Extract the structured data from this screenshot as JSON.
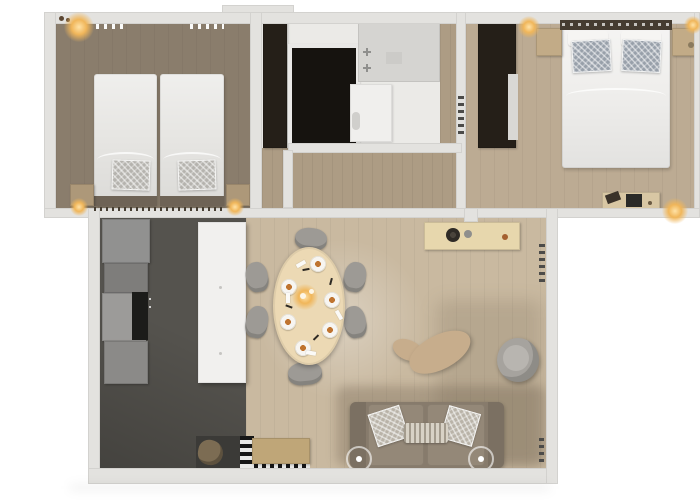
{
  "palette": {
    "background": "#ffffff",
    "wall": "#e3e2df",
    "bedroom1_floor": "#8a7d6c",
    "bedroom2_floor": "#bcab93",
    "hallway_floor": "#ad9c84",
    "bathroom_floor": "#ebeae7",
    "living_wood": "#c9b9a0",
    "kitchen_floor": "#55534e",
    "kitchen_cabinet": "#919190",
    "kitchen_island": "#f1f0ee",
    "dark_wardrobe": "#251f18",
    "shower_dark": "#16130f",
    "shower_tray": "#d5d4d1",
    "bed_linen": "#e7e6e3",
    "bed_linen_double": "#efeeec",
    "pillow_gray": "#b5b3ae",
    "pillow_blue_gray": "#98a0aa",
    "headboard_dark": "#6e6356",
    "headboard_double": "#453c31",
    "nightstand_wood": "#ad9879",
    "nightstand_wood_light": "#c2ab87",
    "desk_wood": "#d8c7a4",
    "sideboard_wood": "#e7d7ad",
    "dining_table": "#ecd9b4",
    "chair_gray": "#9d9a95",
    "sofa_body": "#877b6c",
    "sofa_arm": "#7b7062",
    "sofa_seat": "#948878",
    "sofa_cushion": "#b9b3a8",
    "lumbar_cushion": "#d8d2c6",
    "lounge_beige": "#c7ad8c",
    "tub_chair": "#a6a39e",
    "doormat_dark": "#3b3a37",
    "bench_wood": "#bfa678",
    "stone_decor": "#7c6c53",
    "cooktop_black": "#1c1c1a",
    "warm_light": "#f0b65a"
  },
  "rooms": {
    "bedroom_twin": {
      "furniture": [
        "twin-bed",
        "twin-bed",
        "nightstand",
        "nightstand",
        "ceiling-lamp",
        "curtain-track"
      ]
    },
    "bathroom": {
      "furniture": [
        "tall-cabinet",
        "dark-tiled-shower",
        "shower-tray",
        "faucet-fixtures",
        "toilet"
      ]
    },
    "bedroom_double": {
      "furniture": [
        "double-bed",
        "patterned-pillows",
        "wardrobe",
        "nightstand",
        "nightstand",
        "desk",
        "floor-lamp",
        "radiator"
      ]
    },
    "hallway": {
      "furniture": []
    },
    "living_kitchen": {
      "furniture": [
        "kitchen-cabinets",
        "cooktop",
        "island-counter",
        "oval-dining-table",
        "dining-chairs-x6",
        "place-settings-x6",
        "candle-centerpiece",
        "sideboard",
        "sofa",
        "cushions",
        "side-tables-x2",
        "lounge-chair",
        "tub-chair",
        "entry-bench",
        "striped-doormat",
        "dark-entry-mat",
        "stone-decor",
        "radiator"
      ]
    }
  }
}
